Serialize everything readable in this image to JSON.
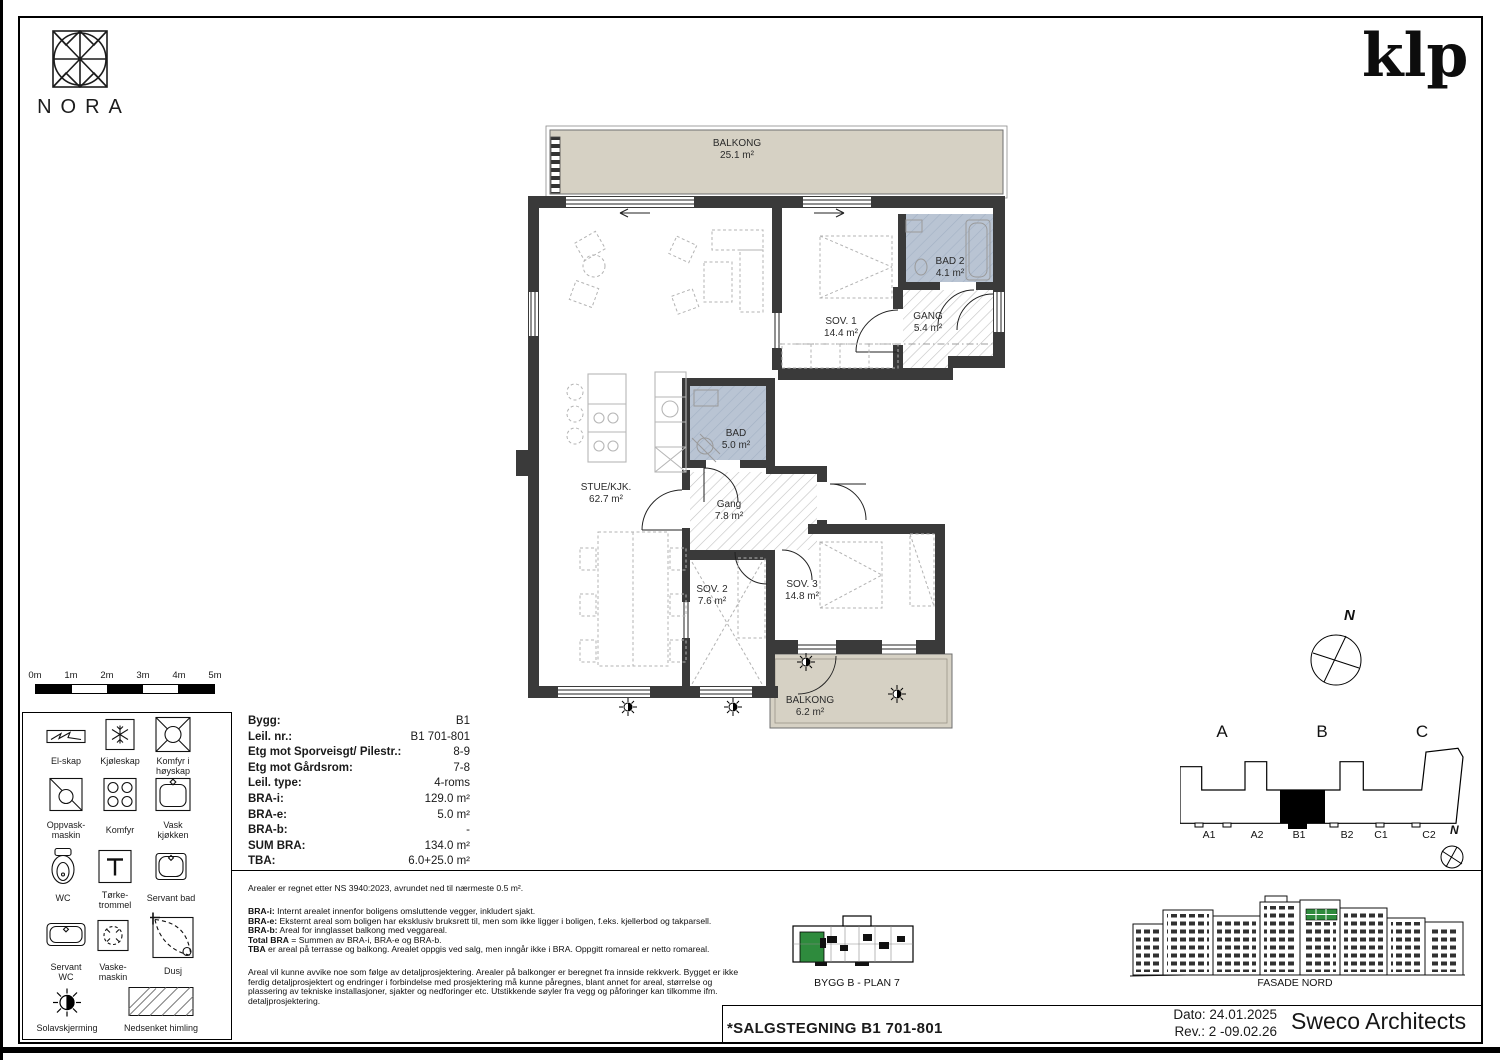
{
  "branding": {
    "nora_logo_text": "NORA",
    "klp_logo_text": "klp"
  },
  "plan": {
    "rooms": [
      {
        "id": "balkong-top",
        "name": "BALKONG",
        "area": "25.1 m²"
      },
      {
        "id": "sov1",
        "name": "SOV. 1",
        "area": "14.4 m²"
      },
      {
        "id": "bad2",
        "name": "BAD 2",
        "area": "4.1 m²"
      },
      {
        "id": "gang2",
        "name": "GANG",
        "area": "5.4 m²"
      },
      {
        "id": "stue",
        "name": "STUE/KJK.",
        "area": "62.7 m²"
      },
      {
        "id": "bad",
        "name": "BAD",
        "area": "5.0 m²"
      },
      {
        "id": "gang",
        "name": "Gang",
        "area": "7.8 m²"
      },
      {
        "id": "sov2",
        "name": "SOV. 2",
        "area": "7.6 m²"
      },
      {
        "id": "sov3",
        "name": "SOV. 3",
        "area": "14.8 m²"
      },
      {
        "id": "balkong-bottom",
        "name": "BALKONG",
        "area": "6.2 m²"
      }
    ],
    "colors": {
      "wall": "#3a3a3a",
      "balcony": "#d6d1c4",
      "bath": "#b9c4d3",
      "hatch": "#c2c2c2",
      "furniture": "#b3b3b3",
      "keyplan_green": "#2e8b3d"
    }
  },
  "scale_bar": {
    "labels": [
      "0m",
      "1m",
      "2m",
      "3m",
      "4m",
      "5m"
    ]
  },
  "legend": {
    "items": [
      "El-skap",
      "Kjøleskap",
      "Komfyr i\nhøyskap",
      "Oppvask-\nmaskin",
      "Komfyr",
      "Vask\nkjøkken",
      "WC",
      "Tørke-\ntrommel",
      "Servant bad",
      "Servant\nWC",
      "Vaske-\nmaskin",
      "Dusj",
      "Solavskjerming",
      "Nedsenket himling"
    ]
  },
  "info_table": {
    "rows": [
      {
        "label": "Bygg:",
        "value": "B1"
      },
      {
        "label": "Leil. nr.:",
        "value": "B1 701-801"
      },
      {
        "label": "Etg mot Sporveisgt/ Pilestr.:",
        "value": "8-9"
      },
      {
        "label": "Etg mot Gårdsrom:",
        "value": "7-8"
      },
      {
        "label": "Leil. type:",
        "value": "4-roms"
      },
      {
        "label": "BRA-i:",
        "value": "129.0 m²"
      },
      {
        "label": "BRA-e:",
        "value": "5.0 m²"
      },
      {
        "label": "BRA-b:",
        "value": "-"
      },
      {
        "label": "SUM BRA:",
        "value": "134.0 m²"
      },
      {
        "label": "TBA:",
        "value": "6.0+25.0 m²"
      }
    ]
  },
  "notes": {
    "intro": "Arealer er regnet etter NS 3940:2023, avrundet ned til nærmeste 0.5 m².",
    "definitions": [
      {
        "b": "BRA-i:",
        "t": " Internt arealet innenfor boligens omsluttende vegger, inkludert sjakt."
      },
      {
        "b": "BRA-e:",
        "t": " Eksternt areal som boligen har eksklusiv bruksrett til, men som ikke ligger i boligen, f.eks. kjellerbod og takparsell."
      },
      {
        "b": "BRA-b:",
        "t": " Areal for innglasset balkong med veggareal."
      },
      {
        "b": "Total BRA",
        "t": " = Summen av BRA-i, BRA-e og BRA-b."
      },
      {
        "b": "TBA",
        "t": " er areal på terrasse og balkong. Arealet oppgis ved salg, men inngår ikke i BRA. Oppgitt romareal er netto romareal."
      }
    ],
    "disclaimer": "Areal vil kunne avvike noe som følge av detaljprosjektering. Arealer på balkonger er beregnet fra innside rekkverk. Bygget er ikke ferdig detaljprosjektert og endringer i forbindelse med prosjektering må kunne påregnes, blant annet for areal, størrelse og plassering av tekniske installasjoner, sjakter og nedforinger etc. Utstikkende søyler fra vegg og påforinger kan tilkomme ifm. detaljprosjektering."
  },
  "key_plan": {
    "caption": "BYGG B - PLAN 7"
  },
  "facade": {
    "caption": "FASADE NORD"
  },
  "building_key": {
    "sections": [
      "A",
      "B",
      "C"
    ],
    "units": [
      "A1",
      "A2",
      "B1",
      "B2",
      "C1",
      "C2"
    ]
  },
  "compass": {
    "north_label": "N"
  },
  "title_block": {
    "drawing_title": "*SALGSTEGNING B1 701-801",
    "date_label": "Dato: 24.01.2025",
    "revision_label": "Rev.: 2 -09.02.26",
    "firm": "Sweco Architects"
  }
}
